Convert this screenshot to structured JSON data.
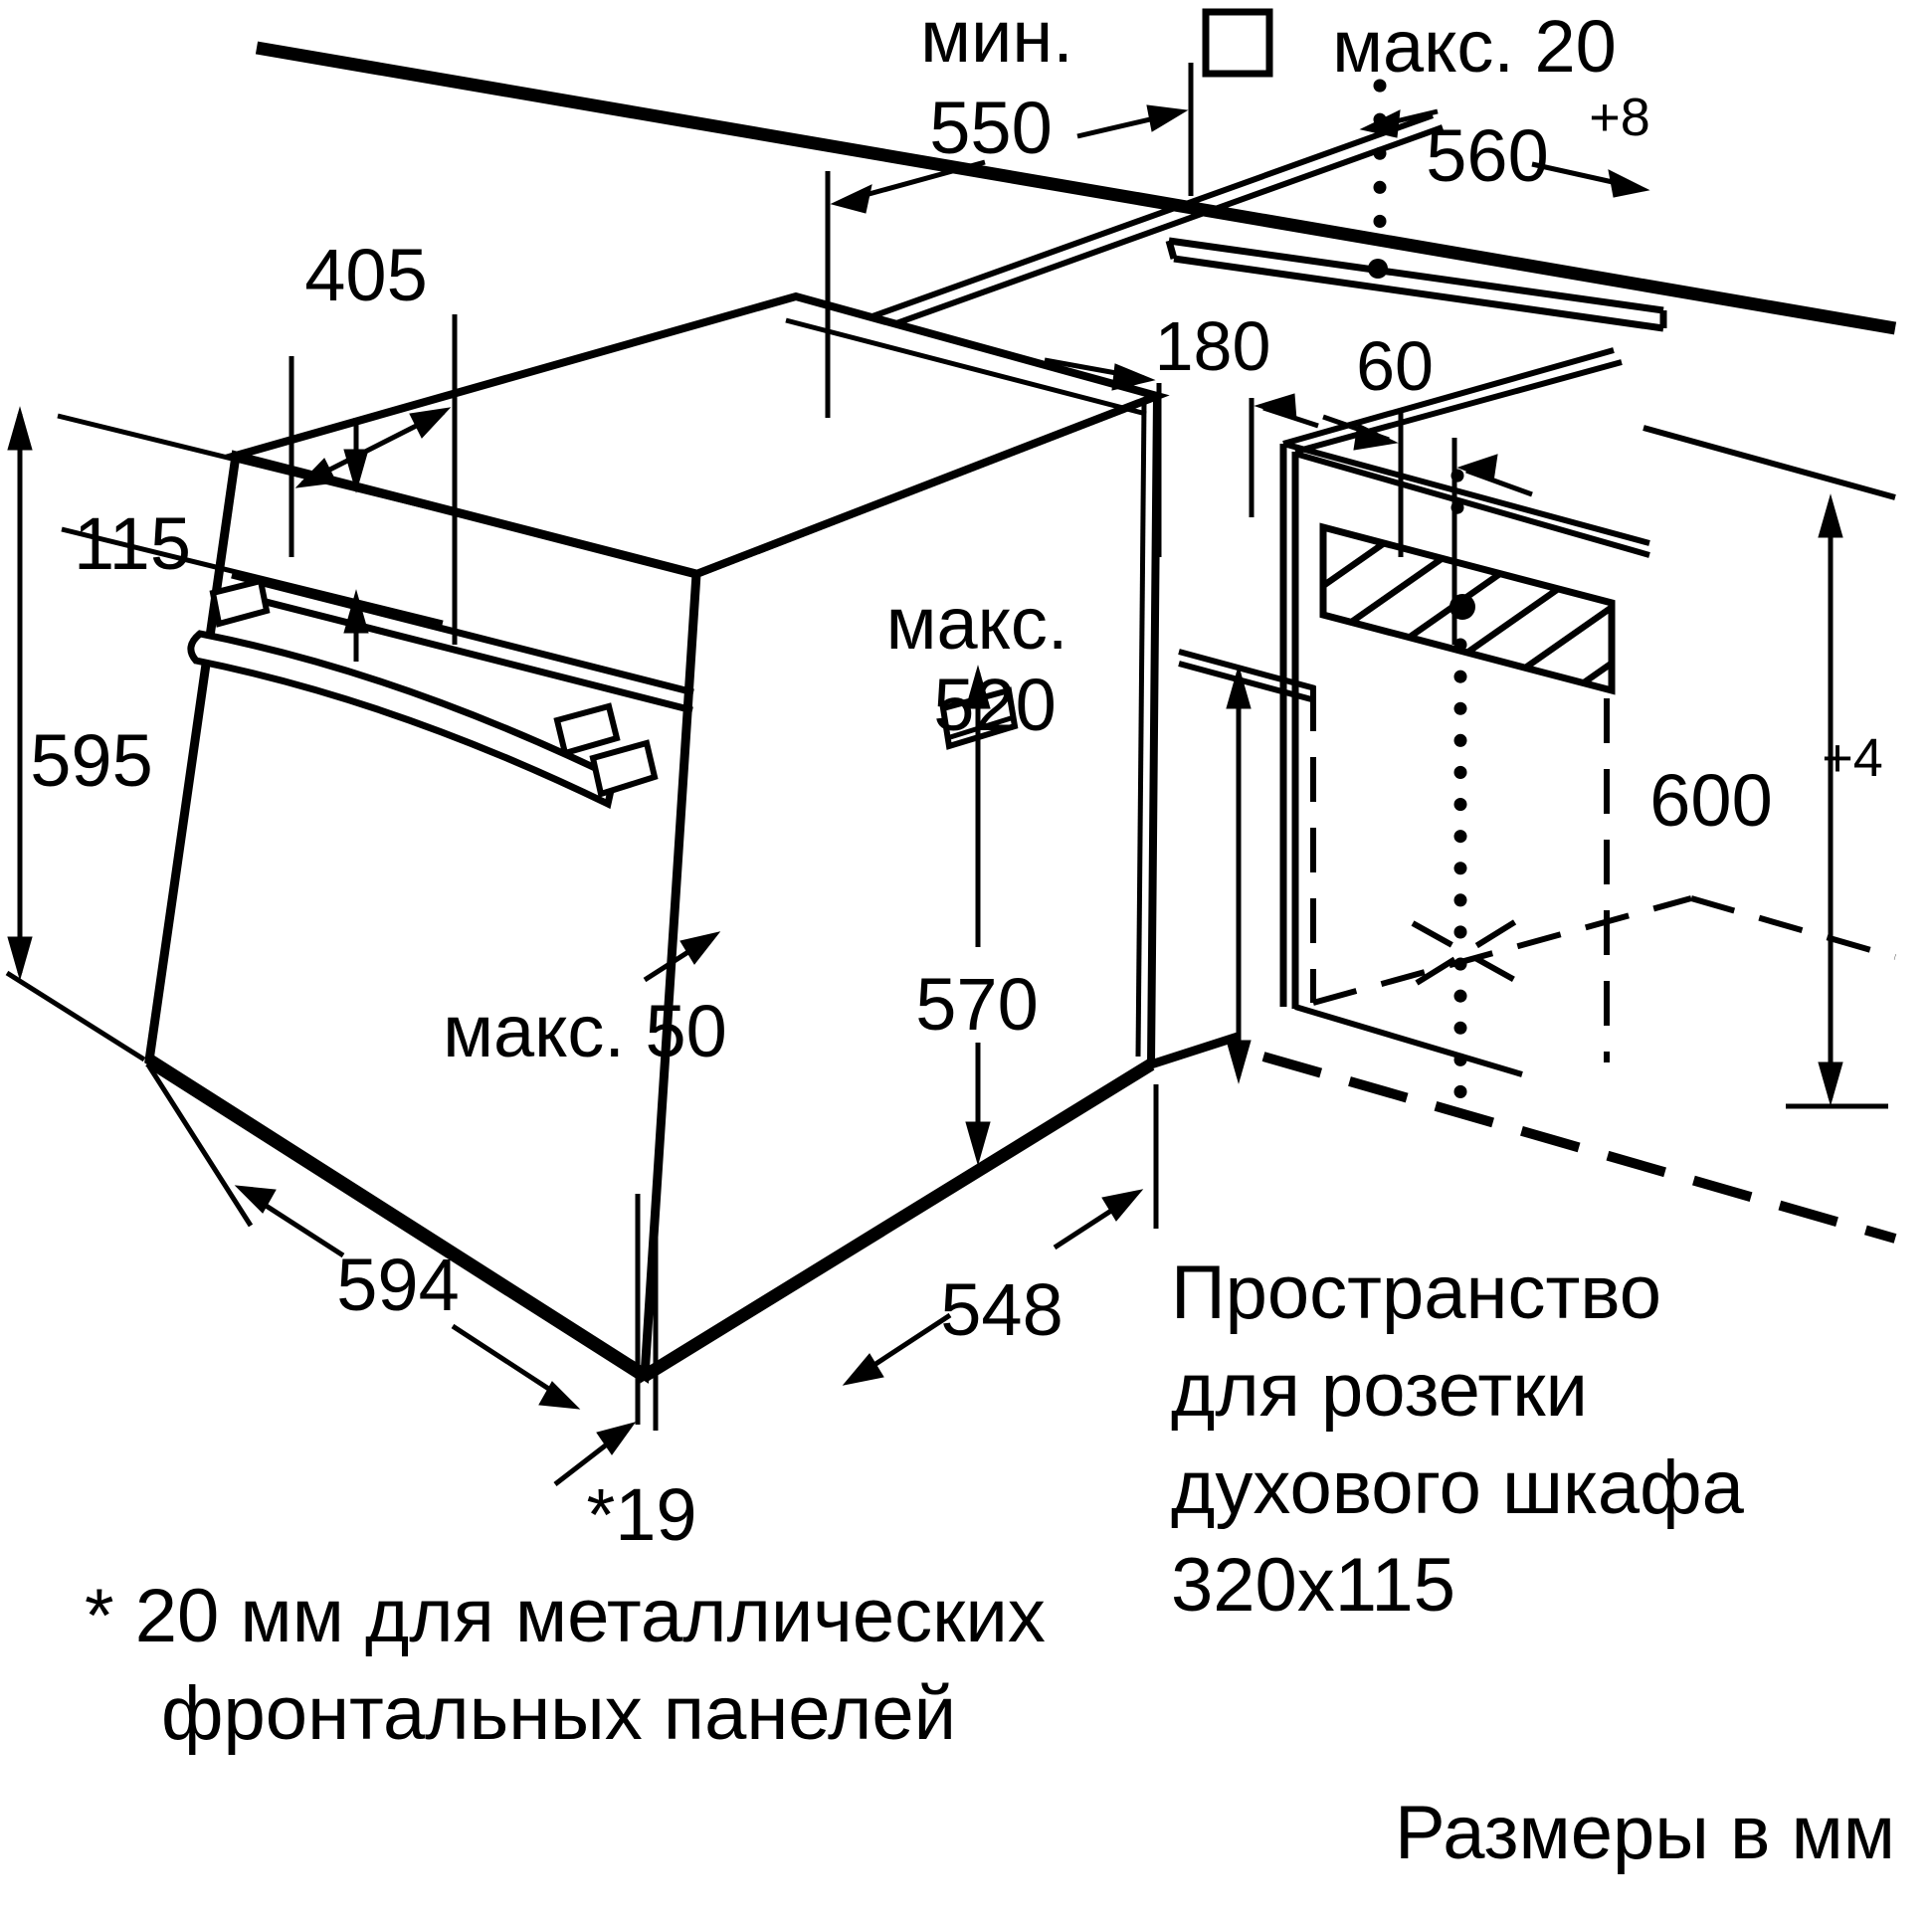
{
  "title": "Схема установки духового шкафа",
  "units_note": "Размеры в мм",
  "colors": {
    "line": "#000000",
    "background": "#ffffff"
  },
  "dimensions": {
    "min_550_prefix": "мин.",
    "min_550_value": "550",
    "max_20": "макс. 20",
    "width_560": "560",
    "width_560_tol": "+8",
    "top_depth_405": "405",
    "panel_115": "115",
    "height_595": "595",
    "recess_180": "180",
    "gap_60": "60",
    "max_520_prefix": "макс.",
    "max_520_value": "520",
    "inner_570": "570",
    "niche_600": "600",
    "niche_600_tol": "+4",
    "max_50": "макс. 50",
    "width_594": "594",
    "depth_548": "548",
    "gap_19": "*19"
  },
  "socket_note": {
    "line1": "Пространство",
    "line2": "для розетки",
    "line3": "духового шкафа",
    "line4": "320x115"
  },
  "footnote": {
    "line1": "* 20 мм для металлических",
    "line2": "фронтальных панелей"
  }
}
